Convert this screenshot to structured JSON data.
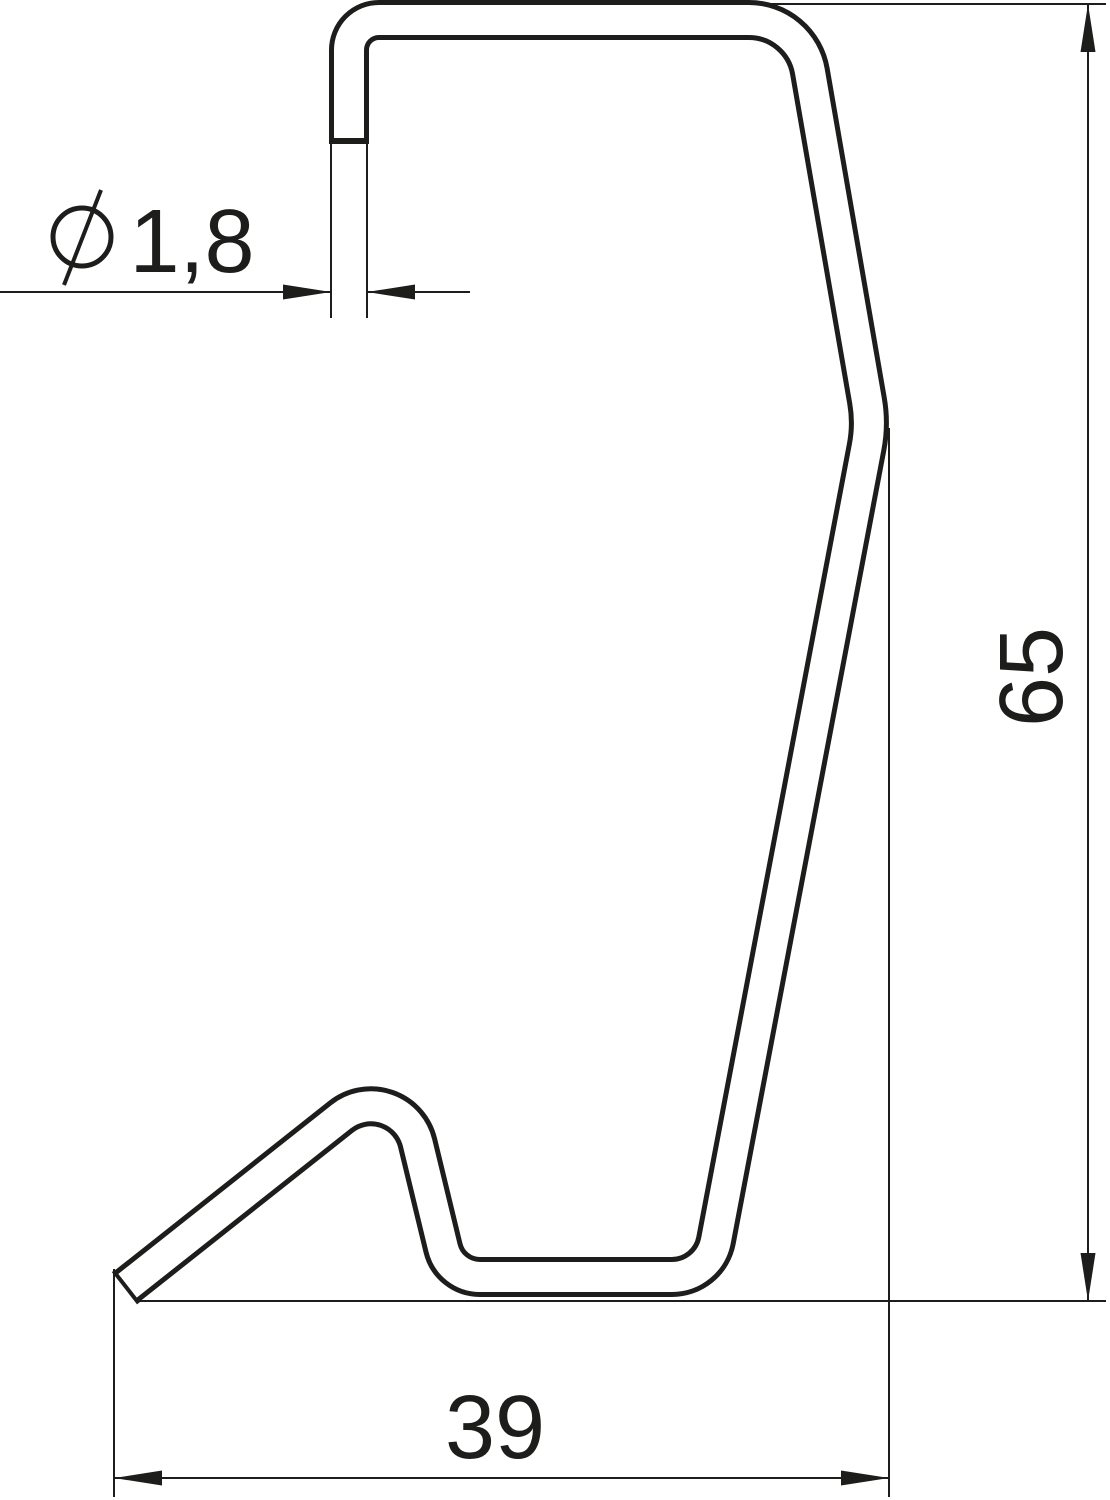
{
  "page": {
    "background": "#ffffff",
    "width": 1110,
    "height": 1500
  },
  "drawing": {
    "ink": "#1d1d1b",
    "font_size": 90,
    "thin_stroke": 2,
    "arrow": {
      "length": 48,
      "half_width": 7.5
    },
    "labels": {
      "diameter": "1,8",
      "height": "65",
      "width": "39"
    },
    "wire": {
      "stroke_width": 40,
      "inner_width": 30,
      "outline_color": "#1d1d1b",
      "fill_color": "#ffffff",
      "centerline_points": [
        [
          126,
          1287
        ],
        [
          400,
          1070
        ],
        [
          450,
          1277
        ],
        [
          709,
          1277
        ],
        [
          871,
          424
        ],
        [
          801,
          20
        ],
        [
          349,
          20
        ],
        [
          349,
          141
        ]
      ],
      "corner_radii": [
        0,
        48,
        38,
        45,
        130,
        62,
        30,
        0
      ],
      "caps": {
        "top": {
          "x1": 329,
          "y1": 141,
          "x2": 369,
          "y2": 141,
          "w": 6
        },
        "tip": {
          "x1": 113.4,
          "y1": 1270.9,
          "x2": 138.6,
          "y2": 1303.1,
          "w": 4
        }
      }
    },
    "dimensions": {
      "diameter": {
        "extension_lines": [
          {
            "x1": 331,
            "y1": 144,
            "x2": 331,
            "y2": 318
          },
          {
            "x1": 367,
            "y1": 144,
            "x2": 367,
            "y2": 318
          }
        ],
        "dimension_lines": [
          {
            "x1": 0,
            "y1": 292,
            "x2": 331,
            "y2": 292
          },
          {
            "x1": 367,
            "y1": 292,
            "x2": 470,
            "y2": 292
          }
        ],
        "arrows": [
          {
            "x": 331,
            "y": 292,
            "angle": 0
          },
          {
            "x": 367,
            "y": 292,
            "angle": 180
          }
        ],
        "symbol": {
          "circle": {
            "cx": 82,
            "cy": 237,
            "r": 29,
            "w": 5
          },
          "slash": {
            "x1": 64,
            "y1": 285,
            "x2": 101,
            "y2": 190,
            "w": 4
          }
        },
        "text": {
          "x": 192,
          "y": 272,
          "anchor": "middle"
        }
      },
      "height": {
        "extension_lines": [
          {
            "x1": 760,
            "y1": 4,
            "x2": 1106,
            "y2": 4
          },
          {
            "x1": 137,
            "y1": 1301,
            "x2": 1106,
            "y2": 1301
          }
        ],
        "dimension_lines": [
          {
            "x1": 1088,
            "y1": 4,
            "x2": 1088,
            "y2": 1301
          }
        ],
        "arrows": [
          {
            "x": 1088,
            "y": 4,
            "angle": -90
          },
          {
            "x": 1088,
            "y": 1301,
            "angle": 90
          }
        ],
        "text": {
          "x": 1062,
          "y": 677,
          "anchor": "middle",
          "rotate": -90
        }
      },
      "width": {
        "extension_lines": [
          {
            "x1": 114,
            "y1": 1269,
            "x2": 114,
            "y2": 1497
          },
          {
            "x1": 889,
            "y1": 428,
            "x2": 889,
            "y2": 1497
          }
        ],
        "dimension_lines": [
          {
            "x1": 114,
            "y1": 1478,
            "x2": 889,
            "y2": 1478
          }
        ],
        "arrows": [
          {
            "x": 114,
            "y": 1478,
            "angle": 180
          },
          {
            "x": 889,
            "y": 1478,
            "angle": 0
          }
        ],
        "text": {
          "x": 495,
          "y": 1458,
          "anchor": "middle"
        }
      }
    }
  }
}
